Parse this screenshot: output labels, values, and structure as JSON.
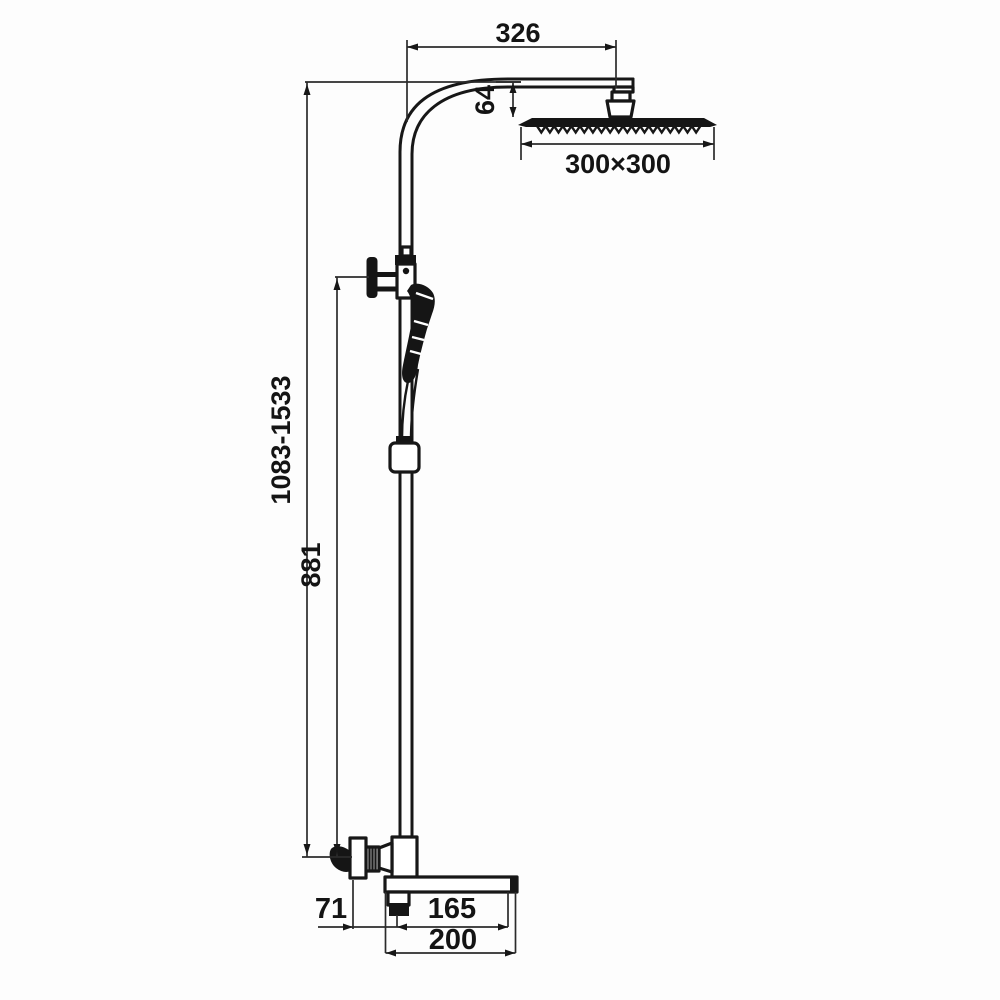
{
  "colors": {
    "background": "#fdfdfd",
    "ink": "#171717",
    "dimension_lines": "#2b2b2b"
  },
  "dimensions": {
    "arm_reach": "326",
    "head_drop": "64",
    "head_size": "300×300",
    "column_height_range": "1083-1533",
    "slide_bar_height": "881",
    "spout_wall_offset": "71",
    "spout_reach": "165",
    "spout_length": "200"
  }
}
